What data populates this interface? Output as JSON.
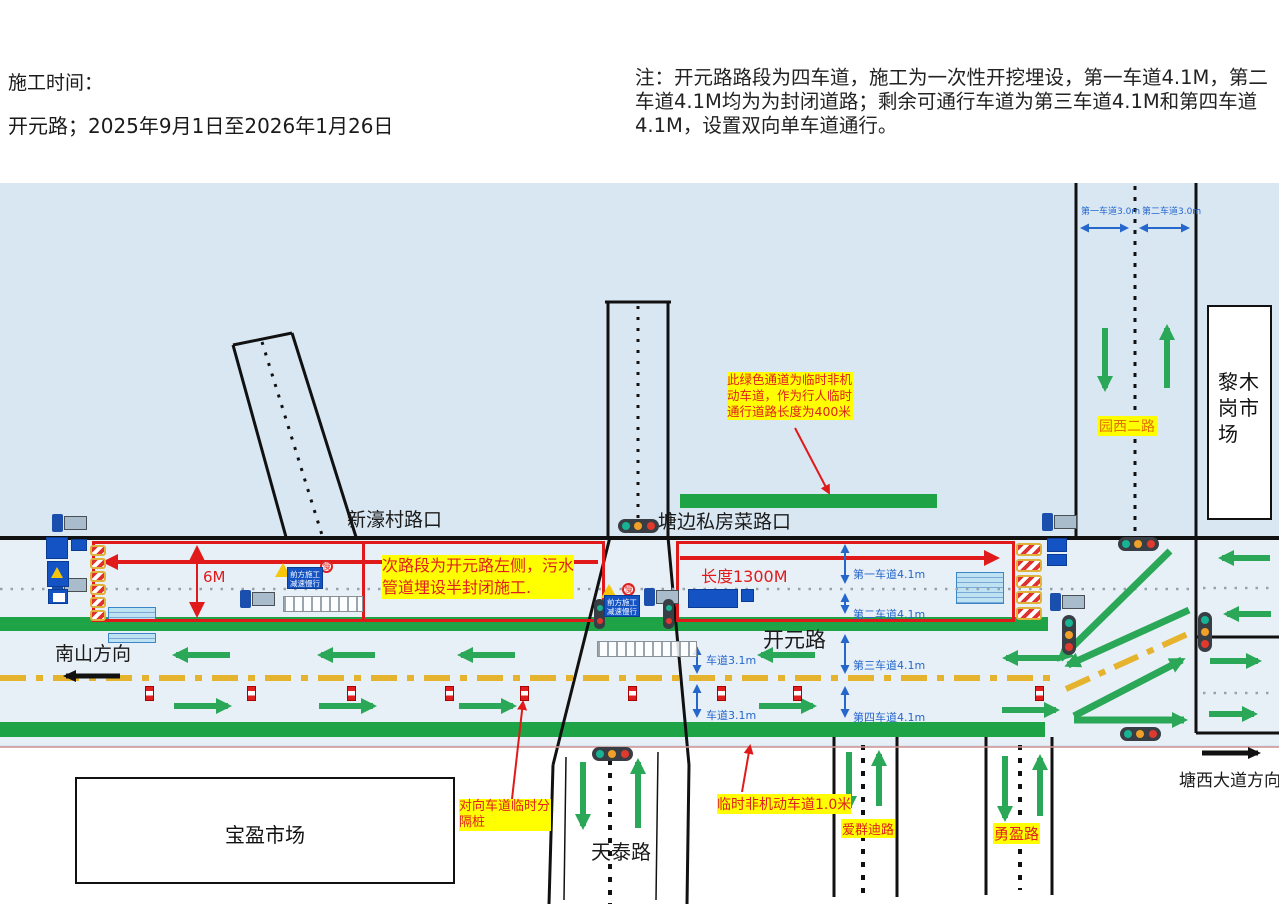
{
  "header": {
    "time_label": "施工时间：",
    "road_period": "开元路；2025年9月1日至2026年1月26日",
    "note": "注：开元路路段为四车道，施工为一次性开挖埋设，第一车道4.1M，第二车道4.1M均为为封闭道路；剩余可通行车道为第三车道4.1M和第四车道4.1M，设置双向单车道通行。"
  },
  "roads": {
    "xinhao_intersection": "新濠村路口",
    "tangbian_intersection": "塘边私房菜路口",
    "nanshan_direction": "南山方向",
    "kaiyuan_road": "开元路",
    "tiantai_road": "天泰路",
    "aiqundi_road": "爱群迪路",
    "yongying_road": "勇盈路",
    "yuanxi_road": "园西二路",
    "tangxi_direction": "塘西大道方向"
  },
  "buildings": {
    "baoying_market": "宝盈市场",
    "limugang_market": "黎木岗市场"
  },
  "annotations": {
    "green_channel_note": "此绿色通道为临时非机动车道，作为行人临时通行道路长度为400米",
    "half_closed_note": "次路段为开元路左侧，污水管道埋设半封闭施工.",
    "length_label": "长度1300M",
    "height_label": "6M",
    "divider_note": "对向车道临时分隔桩",
    "temp_nonmotor_note": "临时非机动车道1.0米"
  },
  "lanes": {
    "lane1": "第一车道4.1m",
    "lane2": "第二车道4.1m",
    "lane3": "第三车道4.1m",
    "lane4": "第四车道4.1m",
    "temp_lane": "车道3.1m",
    "side_lane1": "第一车道3.0m",
    "side_lane2": "第二车道3.0m"
  },
  "signs": {
    "construction_ahead": "前方施工减速慢行",
    "slow": "慢"
  },
  "colors": {
    "sky": "#d9e7f3",
    "road": "#e8f0f7",
    "green": "#1ea347",
    "red": "#e01a1a",
    "highlight_yellow": "#ffff00",
    "center_line_gold": "#e5b32e",
    "sign_blue": "#1453c4",
    "dim_blue": "#2667cc"
  }
}
